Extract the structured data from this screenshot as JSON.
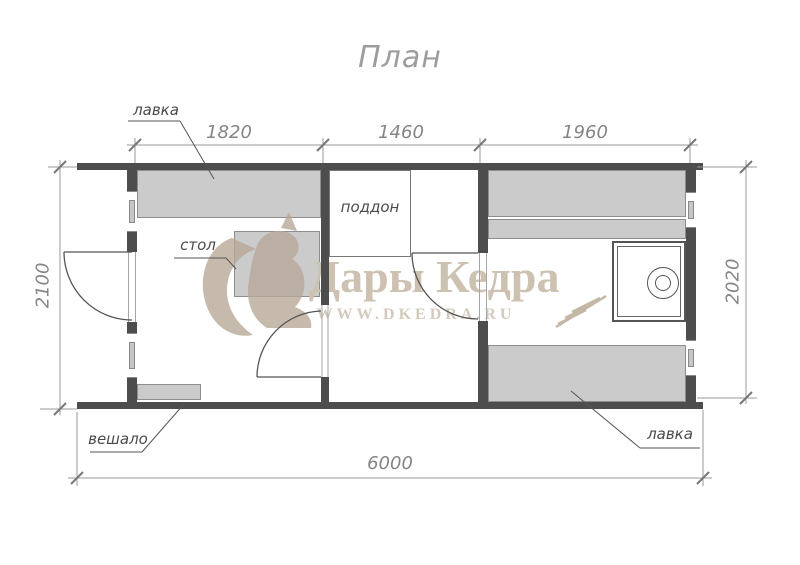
{
  "title": "План",
  "dimensions": {
    "top": [
      "1820",
      "1460",
      "1960"
    ],
    "bottom": "6000",
    "left": "2100",
    "right": "2020"
  },
  "labels": {
    "bench_top": "лавка",
    "table": "стол",
    "tray": "поддон",
    "hanger": "вешало",
    "bench_bottom": "лавка"
  },
  "watermark": {
    "brand": "Дары Кедра",
    "url": "WWW.DKEDRA.RU"
  },
  "colors": {
    "wall": "#4d4d4d",
    "furniture_fill": "#cbcbcb",
    "dimension_line": "#999999",
    "label_text": "#4a4a4a",
    "title_text": "#9d9d9d",
    "watermark_tan": "#cdc1b1"
  }
}
